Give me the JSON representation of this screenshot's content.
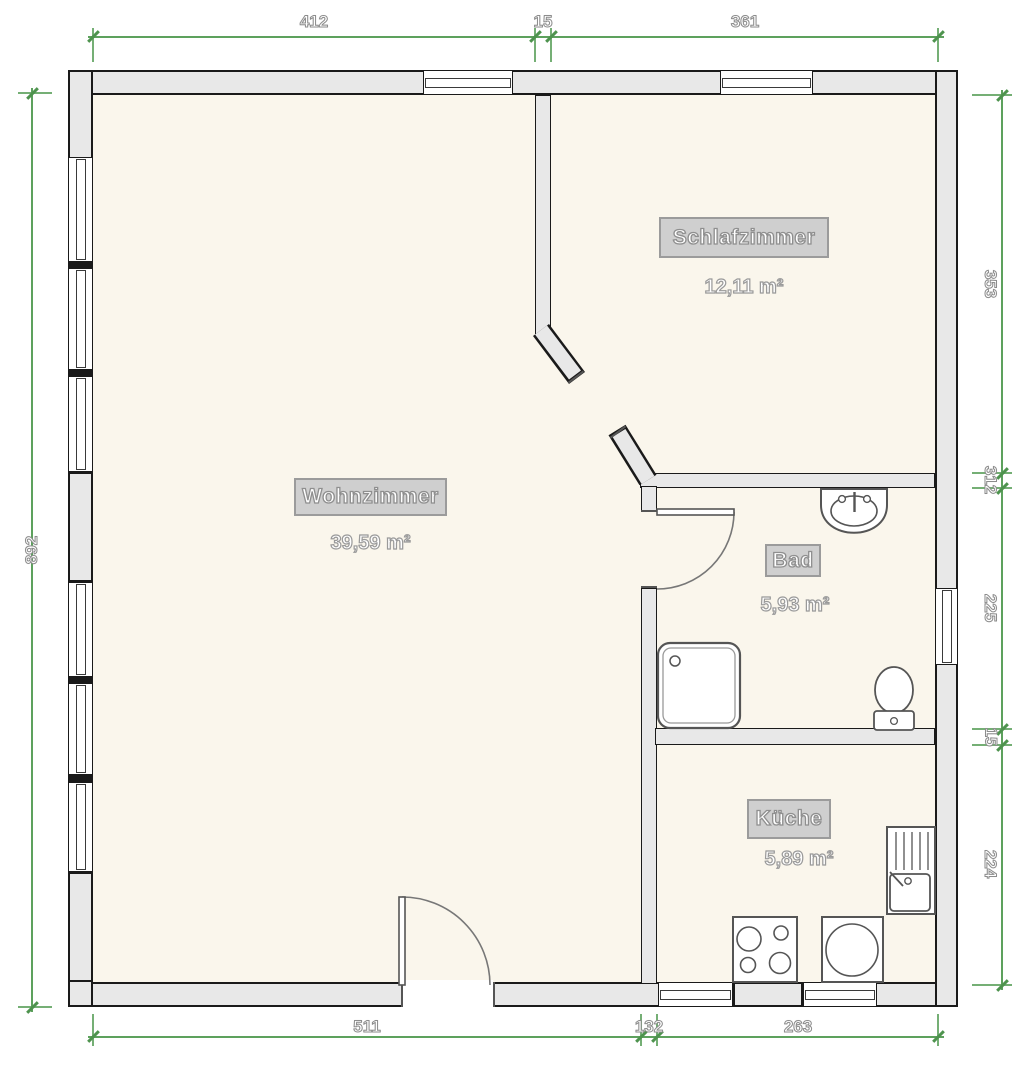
{
  "title": "Grundriss / floor plan",
  "rooms": {
    "wohnzimmer": {
      "name": "Wohnzimmer",
      "area": "39,59 m²"
    },
    "schlafzimmer": {
      "name": "Schlafzimmer",
      "area": "12,11 m²"
    },
    "bad": {
      "name": "Bad",
      "area": "5,93 m²"
    },
    "kueche": {
      "name": "Küche",
      "area": "5,89 m²"
    }
  },
  "dims": {
    "top": [
      "412",
      "15",
      "361"
    ],
    "bottom": [
      "511",
      "132",
      "263"
    ],
    "left": [
      "892"
    ],
    "right": [
      "353",
      "312",
      "225",
      "15",
      "224"
    ]
  },
  "fixtures": {
    "bathroom": [
      "washbasin",
      "shower",
      "toilet"
    ],
    "kitchen": [
      "stove-4-burners",
      "round-appliance",
      "sink-with-drainboard"
    ]
  },
  "colors": {
    "dimension_green": "#5da15d",
    "wall_fill": "#e8e8e8",
    "wall_outline": "#1a1a1a",
    "floor": "#faf6ec",
    "label_box": "#cfcfcf"
  }
}
